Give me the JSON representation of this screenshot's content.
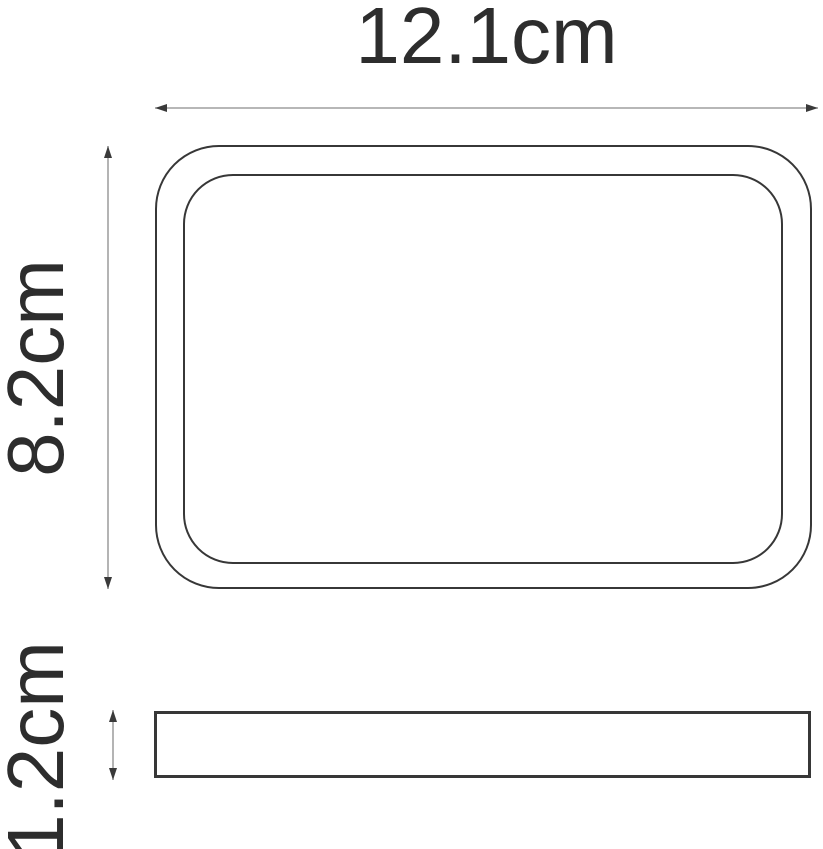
{
  "drawing": {
    "width_label": "12.1cm",
    "height_label": "8.2cm",
    "thickness_label": "1.2cm"
  },
  "dimensions": {
    "width_cm": 12.1,
    "height_cm": 8.2,
    "thickness_cm": 1.2
  },
  "views": {
    "top_view": "rounded-rectangle tray outline with inner rim",
    "side_view": "thin rectangle profile"
  },
  "colors": {
    "background": "#ffffff",
    "text": "#2d2d2d",
    "outline": "#373737",
    "dimension_line": "#8c8c8c",
    "arrowhead": "#3a3a3a"
  }
}
